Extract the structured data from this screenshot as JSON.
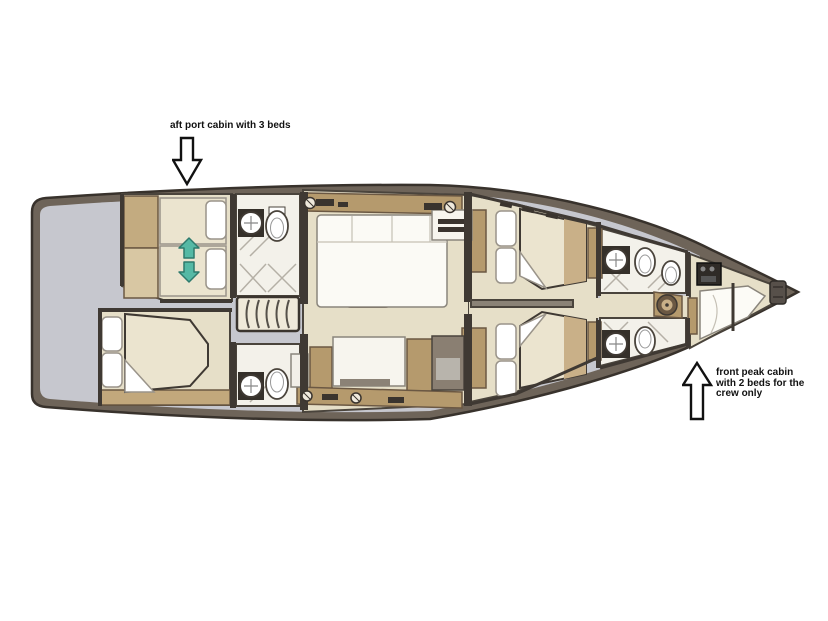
{
  "figure": {
    "kind": "yacht-interior-deck-plan"
  },
  "annotations": {
    "aft_port_cabin": {
      "text": "aft port cabin with 3 beds",
      "arrow_direction": "down"
    },
    "front_peak_cabin": {
      "lines": [
        "front peak cabin",
        "with 2 beds for the",
        "crew only"
      ],
      "arrow_direction": "up"
    }
  },
  "palette": {
    "background": "#ffffff",
    "hull_rim": "#6e6459",
    "hull_outline": "#38322c",
    "deck_gray": "#c6c7ce",
    "floor_cream": "#e6dfc8",
    "head_floor": "#f3f1ea",
    "wall_dark": "#3f3933",
    "cabinet_tan": "#b59a6d",
    "cabinet_outline": "#6b5843",
    "bed_spread": "#ebe4cf",
    "bed_white": "#fcfbf6",
    "table_brown": "#a8905f",
    "arrow_teal": "#55b9a5",
    "annotation_ink": "#111111"
  }
}
